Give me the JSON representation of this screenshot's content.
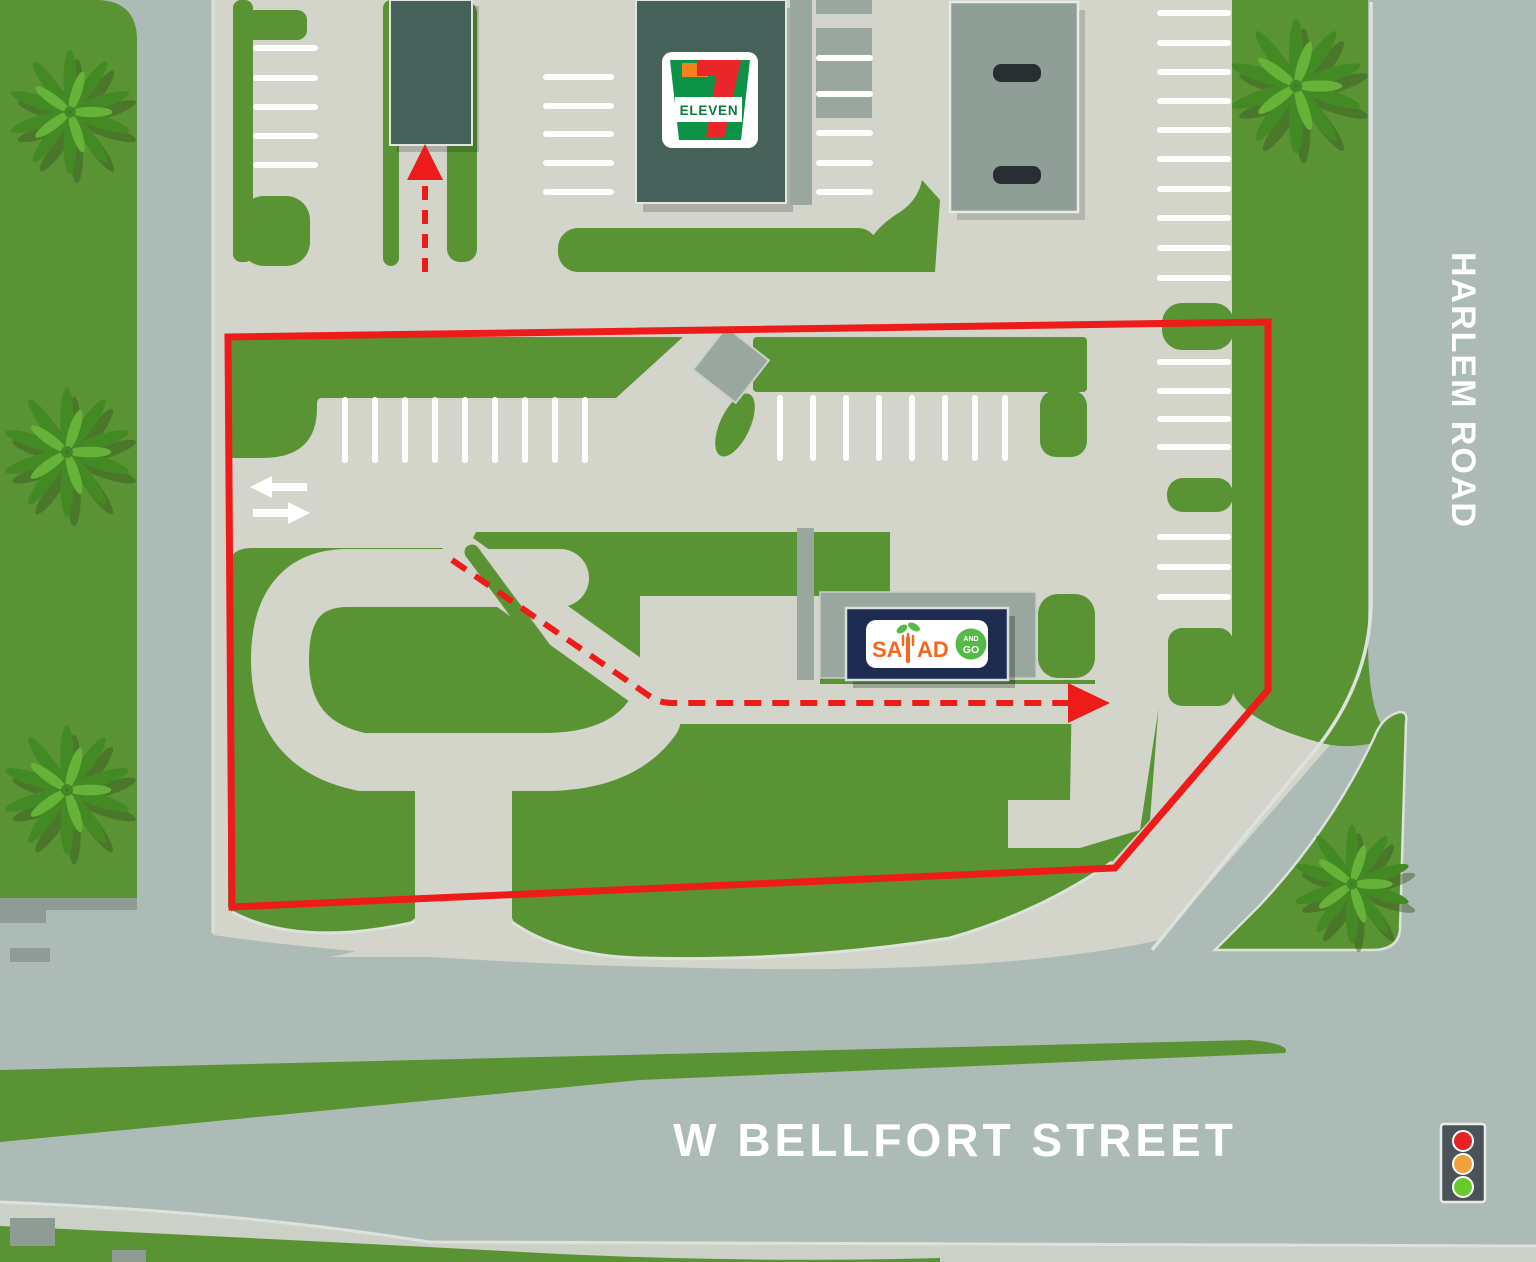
{
  "title": "Salad and Go site access map",
  "streets": {
    "harlem": "HARLEM ROAD",
    "bellfort": "W BELLFORT STREET"
  },
  "businesses": {
    "seven_eleven": {
      "name": "7-Eleven",
      "logo_number": "7",
      "logo_word": "ELEVEN"
    },
    "salad_and_go": {
      "name": "Salad and Go",
      "logo_part1": "SA",
      "logo_part2": "AD",
      "badge_line1": "AND",
      "badge_line2": "GO"
    }
  },
  "annotations": {
    "site_boundary": "red outlined property boundary",
    "drive_route": "red dashed drive-thru route with arrow exiting east",
    "second_route": "red dashed arrow entering 7-Eleven drive-thru lane northbound",
    "aisle_direction": "two-way white traffic arrows",
    "traffic_light": "signal at Harlem Rd / W Bellfort St corner"
  },
  "icons": [
    "palm-tree-icon",
    "traffic-light-icon",
    "route-arrow-icon",
    "two-way-arrows-icon",
    "fork-sprout-icon"
  ],
  "colors": {
    "road": "#adbbb6",
    "lot": "#d3d4ca",
    "grass": "#5a9334",
    "teal": "#46615a",
    "canopy": "#8f9e97",
    "walkway": "#9aa79f",
    "navy": "#1e2c52",
    "red": "#ee1b1b",
    "curb": "#dde3dc",
    "pump": "#272f33",
    "stub": "#8f9c96",
    "sidewalk": "#ccd1c7",
    "sgorange": "#f26822",
    "sggreen": "#56b948",
    "sevgreen": "#0c9347",
    "sevorange": "#f6821f",
    "sevred": "#e9262a",
    "signal_red": "#e82222",
    "signal_amber": "#f0a13b",
    "signal_green": "#66cb2d"
  }
}
